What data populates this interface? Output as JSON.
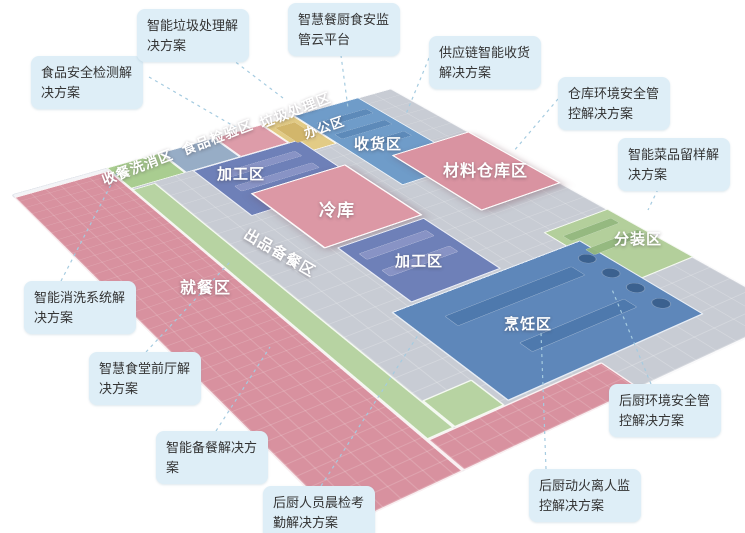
{
  "meta": {
    "title": "智慧食堂立体分区示意图",
    "background": "#ffffff"
  },
  "colors": {
    "callout_bg": "#deeef7",
    "callout_text": "#333333",
    "leader_line": "#a5cbe0",
    "floor_label_text": "#ffffff",
    "slab": "#f3f4f7",
    "kitchen_floor": "#c8ccd4",
    "dining_pink": "#d8919f",
    "cold_pink": "#dc98a5",
    "zone_blue": "#6e80b8",
    "cooking_blue": "#5e87ba",
    "receiving_blue": "#6f9cc9",
    "corridor_green": "#b7d3a2",
    "strip_green": "#a9cd90",
    "inspect_slate": "#97adc6",
    "office_yellow": "#e2cb85"
  },
  "zones": [
    {
      "name": "building-slab",
      "plan": [
        0,
        0,
        900,
        1150
      ],
      "color": "#f3f4f7",
      "cls": "base"
    },
    {
      "name": "kitchen-floor",
      "plan": [
        200,
        0,
        700,
        1150
      ],
      "color": "#c8ccd4",
      "cls": "floor"
    },
    {
      "name": "zone-dining",
      "plan": [
        0,
        15,
        200,
        1135
      ],
      "color": "#d8919f",
      "cls": "room tiles"
    },
    {
      "name": "zone-dining-south",
      "plan": [
        200,
        1065,
        340,
        85
      ],
      "color": "#d8919f",
      "cls": "room tiles"
    },
    {
      "name": "zone-dish-return-wash",
      "plan": [
        200,
        0,
        120,
        110
      ],
      "color": "#a9cd90",
      "cls": "room"
    },
    {
      "name": "zone-food-inspection",
      "plan": [
        320,
        0,
        125,
        110
      ],
      "color": "#97adc6",
      "cls": "room"
    },
    {
      "name": "zone-garbage",
      "plan": [
        445,
        0,
        115,
        110
      ],
      "color": "#dd9ca9",
      "cls": "room"
    },
    {
      "name": "zone-office",
      "plan": [
        560,
        0,
        80,
        170
      ],
      "color": "#e2cb85",
      "cls": "room"
    },
    {
      "name": "zone-receiving",
      "plan": [
        640,
        0,
        170,
        400
      ],
      "color": "#6f9cc9",
      "cls": "room"
    },
    {
      "name": "zone-processing-1",
      "plan": [
        335,
        110,
        250,
        230
      ],
      "color": "#6e80b8",
      "cls": "room"
    },
    {
      "name": "zone-corridor-serving",
      "plan": [
        200,
        115,
        50,
        950
      ],
      "color": "#b7d3a2",
      "cls": "room"
    },
    {
      "name": "zone-corridor-hook",
      "plan": [
        250,
        985,
        95,
        80
      ],
      "color": "#b7d3a2",
      "cls": "room"
    },
    {
      "name": "zone-cold-storage",
      "plan": [
        380,
        260,
        220,
        260
      ],
      "color": "#dc98a5",
      "cls": "elev"
    },
    {
      "name": "zone-processing-2",
      "plan": [
        400,
        530,
        195,
        225
      ],
      "color": "#6e80b8",
      "cls": "room"
    },
    {
      "name": "zone-material-warehouse",
      "plan": [
        700,
        280,
        200,
        290
      ],
      "color": "#d993a1",
      "cls": "elev"
    },
    {
      "name": "zone-packing",
      "plan": [
        740,
        700,
        160,
        220
      ],
      "color": "#b3cf9b",
      "cls": "room"
    },
    {
      "name": "zone-cooking",
      "plan": [
        355,
        760,
        420,
        300
      ],
      "color": "#5e87ba",
      "cls": "room"
    },
    {
      "name": "equip-receiving-shelf-1",
      "plan": [
        660,
        60,
        130,
        28
      ],
      "color": "#5d8ab9",
      "cls": "equip"
    },
    {
      "name": "equip-receiving-shelf-2",
      "plan": [
        660,
        130,
        130,
        28
      ],
      "color": "#5d8ab9",
      "cls": "equip"
    },
    {
      "name": "equip-receiving-shelf-3",
      "plan": [
        660,
        200,
        130,
        28
      ],
      "color": "#5d8ab9",
      "cls": "equip"
    },
    {
      "name": "equip-processing1-table-1",
      "plan": [
        370,
        150,
        180,
        28
      ],
      "color": "#8a95c6",
      "cls": "equip"
    },
    {
      "name": "equip-processing1-table-2",
      "plan": [
        370,
        215,
        180,
        28
      ],
      "color": "#8a95c6",
      "cls": "equip"
    },
    {
      "name": "equip-processing2-table-1",
      "plan": [
        420,
        570,
        150,
        26
      ],
      "color": "#8a95c6",
      "cls": "equip"
    },
    {
      "name": "equip-processing2-table-2",
      "plan": [
        420,
        640,
        150,
        26
      ],
      "color": "#8a95c6",
      "cls": "equip"
    },
    {
      "name": "equip-cooking-counter-1",
      "plan": [
        420,
        820,
        280,
        36
      ],
      "color": "#4e79ad",
      "cls": "equip"
    },
    {
      "name": "equip-cooking-counter-2",
      "plan": [
        470,
        950,
        230,
        32
      ],
      "color": "#4e79ad",
      "cls": "equip"
    },
    {
      "name": "equip-wok-1",
      "plan": [
        725,
        800,
        32,
        32
      ],
      "color": "#3a5f8d",
      "cls": "equip round"
    },
    {
      "name": "equip-wok-2",
      "plan": [
        725,
        860,
        32,
        32
      ],
      "color": "#3a5f8d",
      "cls": "equip round"
    },
    {
      "name": "equip-wok-3",
      "plan": [
        725,
        920,
        32,
        32
      ],
      "color": "#3a5f8d",
      "cls": "equip round"
    },
    {
      "name": "equip-wok-4",
      "plan": [
        725,
        980,
        32,
        32
      ],
      "color": "#3a5f8d",
      "cls": "equip round"
    },
    {
      "name": "equip-packing-bench-1",
      "plan": [
        760,
        730,
        120,
        24
      ],
      "color": "#94b87f",
      "cls": "equip"
    },
    {
      "name": "equip-packing-bench-2",
      "plan": [
        760,
        790,
        130,
        24
      ],
      "color": "#94b87f",
      "cls": "equip"
    },
    {
      "name": "equip-office-desk",
      "plan": [
        575,
        30,
        50,
        90
      ],
      "color": "#d2b56a",
      "cls": "equip"
    }
  ],
  "floor_labels": [
    {
      "name": "floor-label-dish-return-wash",
      "text": "收餐洗消区",
      "x": 100,
      "y": 157,
      "size": 14,
      "rot": -21
    },
    {
      "name": "floor-label-food-inspection",
      "text": "食品检验区",
      "x": 180,
      "y": 127,
      "size": 14,
      "rot": -21
    },
    {
      "name": "floor-label-garbage",
      "text": "垃圾处理区",
      "x": 258,
      "y": 100,
      "size": 14,
      "rot": -21
    },
    {
      "name": "floor-label-office",
      "text": "办公区",
      "x": 303,
      "y": 117,
      "size": 13,
      "rot": -19
    },
    {
      "name": "floor-label-receiving",
      "text": "收货区",
      "x": 354,
      "y": 133,
      "size": 15,
      "rot": 0
    },
    {
      "name": "floor-label-material-warehouse",
      "text": "材料仓库区",
      "x": 443,
      "y": 157,
      "size": 16,
      "rot": 0
    },
    {
      "name": "floor-label-processing-1",
      "text": "加工区",
      "x": 217,
      "y": 163,
      "size": 15,
      "rot": 0
    },
    {
      "name": "floor-label-cold-storage",
      "text": "冷库",
      "x": 319,
      "y": 196,
      "size": 17,
      "rot": 0
    },
    {
      "name": "floor-label-processing-2",
      "text": "加工区",
      "x": 395,
      "y": 250,
      "size": 15,
      "rot": 0
    },
    {
      "name": "floor-label-serving-corridor",
      "text": "出品备餐区",
      "x": 240,
      "y": 242,
      "size": 15,
      "rot": 30
    },
    {
      "name": "floor-label-dining",
      "text": "就餐区",
      "x": 180,
      "y": 274,
      "size": 16,
      "rot": 0
    },
    {
      "name": "floor-label-cooking",
      "text": "烹饪区",
      "x": 504,
      "y": 313,
      "size": 15,
      "rot": 0
    },
    {
      "name": "floor-label-packing",
      "text": "分装区",
      "x": 614,
      "y": 228,
      "size": 15,
      "rot": 0
    }
  ],
  "callouts": [
    {
      "name": "callout-food-safety-testing",
      "text": "食品安全检测解决方案",
      "x": 31,
      "y": 56,
      "w": 92,
      "line": [
        149,
        77,
        237,
        128
      ]
    },
    {
      "name": "callout-smart-garbage",
      "text": "智能垃圾处理解决方案",
      "x": 137,
      "y": 9,
      "w": 92,
      "line": [
        225,
        54,
        283,
        98
      ]
    },
    {
      "name": "callout-cloud-platform",
      "text": "智慧餐厨食安监管云平台",
      "x": 288,
      "y": 3,
      "w": 92,
      "line": [
        340,
        48,
        348,
        108
      ]
    },
    {
      "name": "callout-supply-chain-receiving",
      "text": "供应链智能收货解决方案",
      "x": 429,
      "y": 36,
      "w": 92,
      "line": [
        429,
        58,
        406,
        114
      ]
    },
    {
      "name": "callout-warehouse-env",
      "text": "仓库环境安全管控解决方案",
      "x": 558,
      "y": 77,
      "w": 92,
      "line": [
        558,
        99,
        513,
        152
      ]
    },
    {
      "name": "callout-dish-sampling",
      "text": "智能菜品留样解决方案",
      "x": 618,
      "y": 138,
      "w": 92,
      "line": [
        661,
        183,
        648,
        210
      ]
    },
    {
      "name": "callout-smart-washing",
      "text": "智能消洗系统解决方案",
      "x": 24,
      "y": 281,
      "w": 92,
      "line": [
        61,
        281,
        117,
        173
      ]
    },
    {
      "name": "callout-front-hall",
      "text": "智慧食堂前厅解决方案",
      "x": 89,
      "y": 352,
      "w": 92,
      "line": [
        146,
        352,
        230,
        262
      ]
    },
    {
      "name": "callout-smart-meal-prep",
      "text": "智能备餐解决方案",
      "x": 156,
      "y": 431,
      "w": 92,
      "line": [
        216,
        431,
        270,
        347
      ]
    },
    {
      "name": "callout-morning-check",
      "text": "后厨人员晨检考勤解决方案",
      "x": 263,
      "y": 486,
      "w": 92,
      "line": [
        321,
        486,
        420,
        332
      ]
    },
    {
      "name": "callout-kitchen-env",
      "text": "后厨环境安全管控解决方案",
      "x": 609,
      "y": 384,
      "w": 92,
      "line": [
        651,
        384,
        611,
        287
      ]
    },
    {
      "name": "callout-fire-monitoring",
      "text": "后厨动火离人监控解决方案",
      "x": 529,
      "y": 469,
      "w": 92,
      "line": [
        546,
        469,
        541,
        332
      ]
    }
  ]
}
